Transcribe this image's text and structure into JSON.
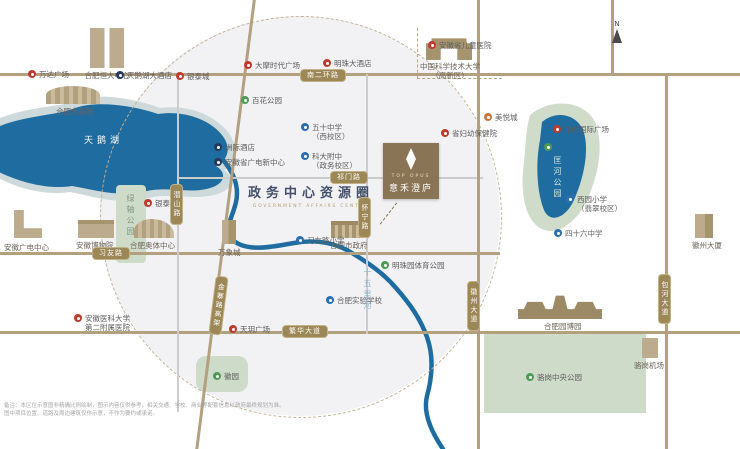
{
  "title": {
    "cn": "政务中心资源圈",
    "en": "GOVERNMENT AFFAIRS CENTER"
  },
  "card": {
    "en": "TOP OPUS",
    "cn": "意禾澄庐"
  },
  "compass": {
    "n": "N"
  },
  "water": {
    "swan_lake": "天鹅湖",
    "shiwuli_river": "十五里河"
  },
  "roads": {
    "nanerhuan": "南二环路",
    "qimen": "祁门路",
    "xiyou": "习友路",
    "fanhua": "繁华大道",
    "qianshan": "潜山路",
    "huaining": "怀宁路",
    "jinzhai": "金寨路高架",
    "huizhou": "徽州大道",
    "baohe": "包河大道"
  },
  "parks": {
    "lvzhou": "绿轴公园",
    "kuanghe": "匡河公园",
    "luogang": "骆岗中央公园",
    "huiyuan": "徽园",
    "mingzhu_sports": "明珠园体育公园",
    "baihua": "百花公园"
  },
  "poi": {
    "wanda": "万达广场",
    "hengda": "合肥恒大中心",
    "swan_hotel": "天鹅湖大酒店",
    "yintai_north": "银泰城",
    "damo": "大摩时代广场",
    "mingzhu_hotel": "明珠大酒店",
    "children_hospital": "安徽省儿童医院",
    "ustc1": "中国科学技术大学",
    "ustc2": "（高新区）",
    "grand_theatre": "合肥大剧院",
    "intercontinental": "洲际酒店",
    "guangdian_new": "安徽省广电新中心",
    "school50w1": "五十中学",
    "school50w2": "（西校区）",
    "kdfz1": "科大附中",
    "kdfz2": "（政务校区）",
    "yintai_city": "银泰city",
    "museum": "安徽博物院",
    "aoti": "合肥奥体中心",
    "guangdian": "安徽广电中心",
    "mixc": "万象城",
    "city_gov": "合肥市政府",
    "xiyou_school": "习友路小学",
    "fuyou": "省妇幼保健院",
    "experimental": "合肥实验学校",
    "tianyue": "天玥广场",
    "anyi1": "安徽医科大学",
    "anyi2": "第二附属医院",
    "meiyue": "美悦城",
    "jiaqiao": "加侨国际广场",
    "xiyuan1": "西园小学",
    "xiyuan2": "（翡翠校区）",
    "school46": "四十六中学",
    "yuanbo": "合肥园博园",
    "luogang_airport": "骆岗机场",
    "huizhou_tower": "徽州大厦"
  },
  "disclaimer": {
    "line1": "备注：本区位示意图非精确比例绘制，图示内容仅供参考，相关交通、学校、商业等配套信息以政府最终规划为准。",
    "line2": "图中项目位置、道路及周边建筑仅作示意，不作为要约或承诺。"
  }
}
